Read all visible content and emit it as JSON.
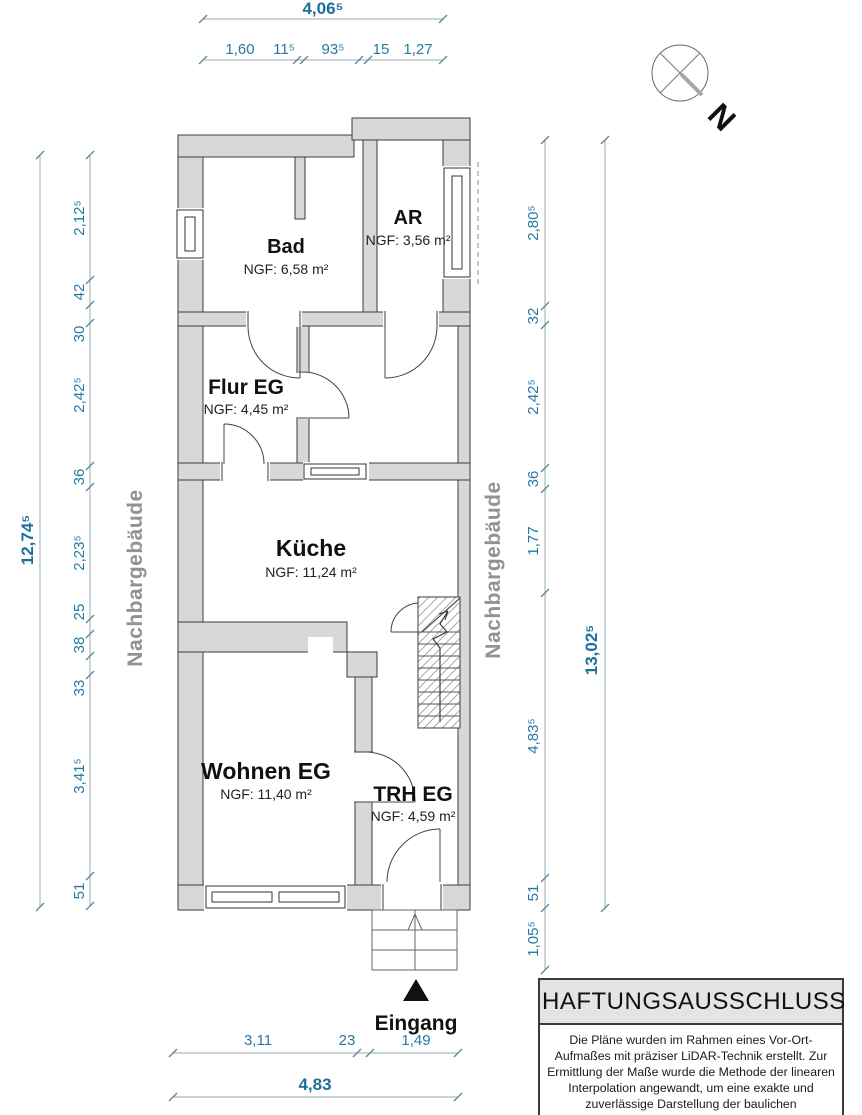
{
  "plan": {
    "rooms": [
      {
        "name": "Bad",
        "area": "NGF: 6,58 m²"
      },
      {
        "name": "AR",
        "area": "NGF: 3,56 m²"
      },
      {
        "name": "Flur EG",
        "area": "NGF: 4,45 m²"
      },
      {
        "name": "Küche",
        "area": "NGF: 11,24 m²"
      },
      {
        "name": "Wohnen EG",
        "area": "NGF: 11,40 m²"
      },
      {
        "name": "TRH EG",
        "area": "NGF: 4,59 m²"
      }
    ],
    "entrance_label": "Eingang",
    "neighbor_left": "Nachbargebäude",
    "neighbor_right": "Nachbargebäude",
    "compass_label": "N"
  },
  "dimensions": {
    "top_total": "4,06⁵",
    "top": [
      "1,60",
      "11⁵",
      "93⁵",
      "15",
      "1,27"
    ],
    "left_total": "12,74⁵",
    "left": [
      "2,12⁵",
      "42",
      "30",
      "2,42⁵",
      "36",
      "2,23⁵",
      "25",
      "38",
      "33",
      "3,41⁵",
      "51"
    ],
    "right_total": "13,02⁵",
    "right": [
      "2,80⁵",
      "32",
      "2,42⁵",
      "36",
      "1,77",
      "4,83⁵",
      "51",
      "1,05⁵"
    ],
    "bottom": [
      "3,11",
      "23",
      "1,49"
    ],
    "bottom_total": "4,83"
  },
  "disclaimer": {
    "title": "HAFTUNGSAUSSCHLUSS",
    "body": "Die Pläne wurden im Rahmen eines Vor-Ort-Aufmaßes mit präziser LiDAR-Technik erstellt. Zur Ermittlung der Maße wurde die Methode der linearen Interpolation angewandt, um eine exakte und zuverlässige Darstellung der baulichen Gegebenheiten zu gewährleisten."
  },
  "colors": {
    "dimension_text": "#2579a4",
    "dimension_total_text": "#1d6f9b",
    "wall_fill": "#d8d8d8",
    "neighbor_text": "#929292"
  }
}
